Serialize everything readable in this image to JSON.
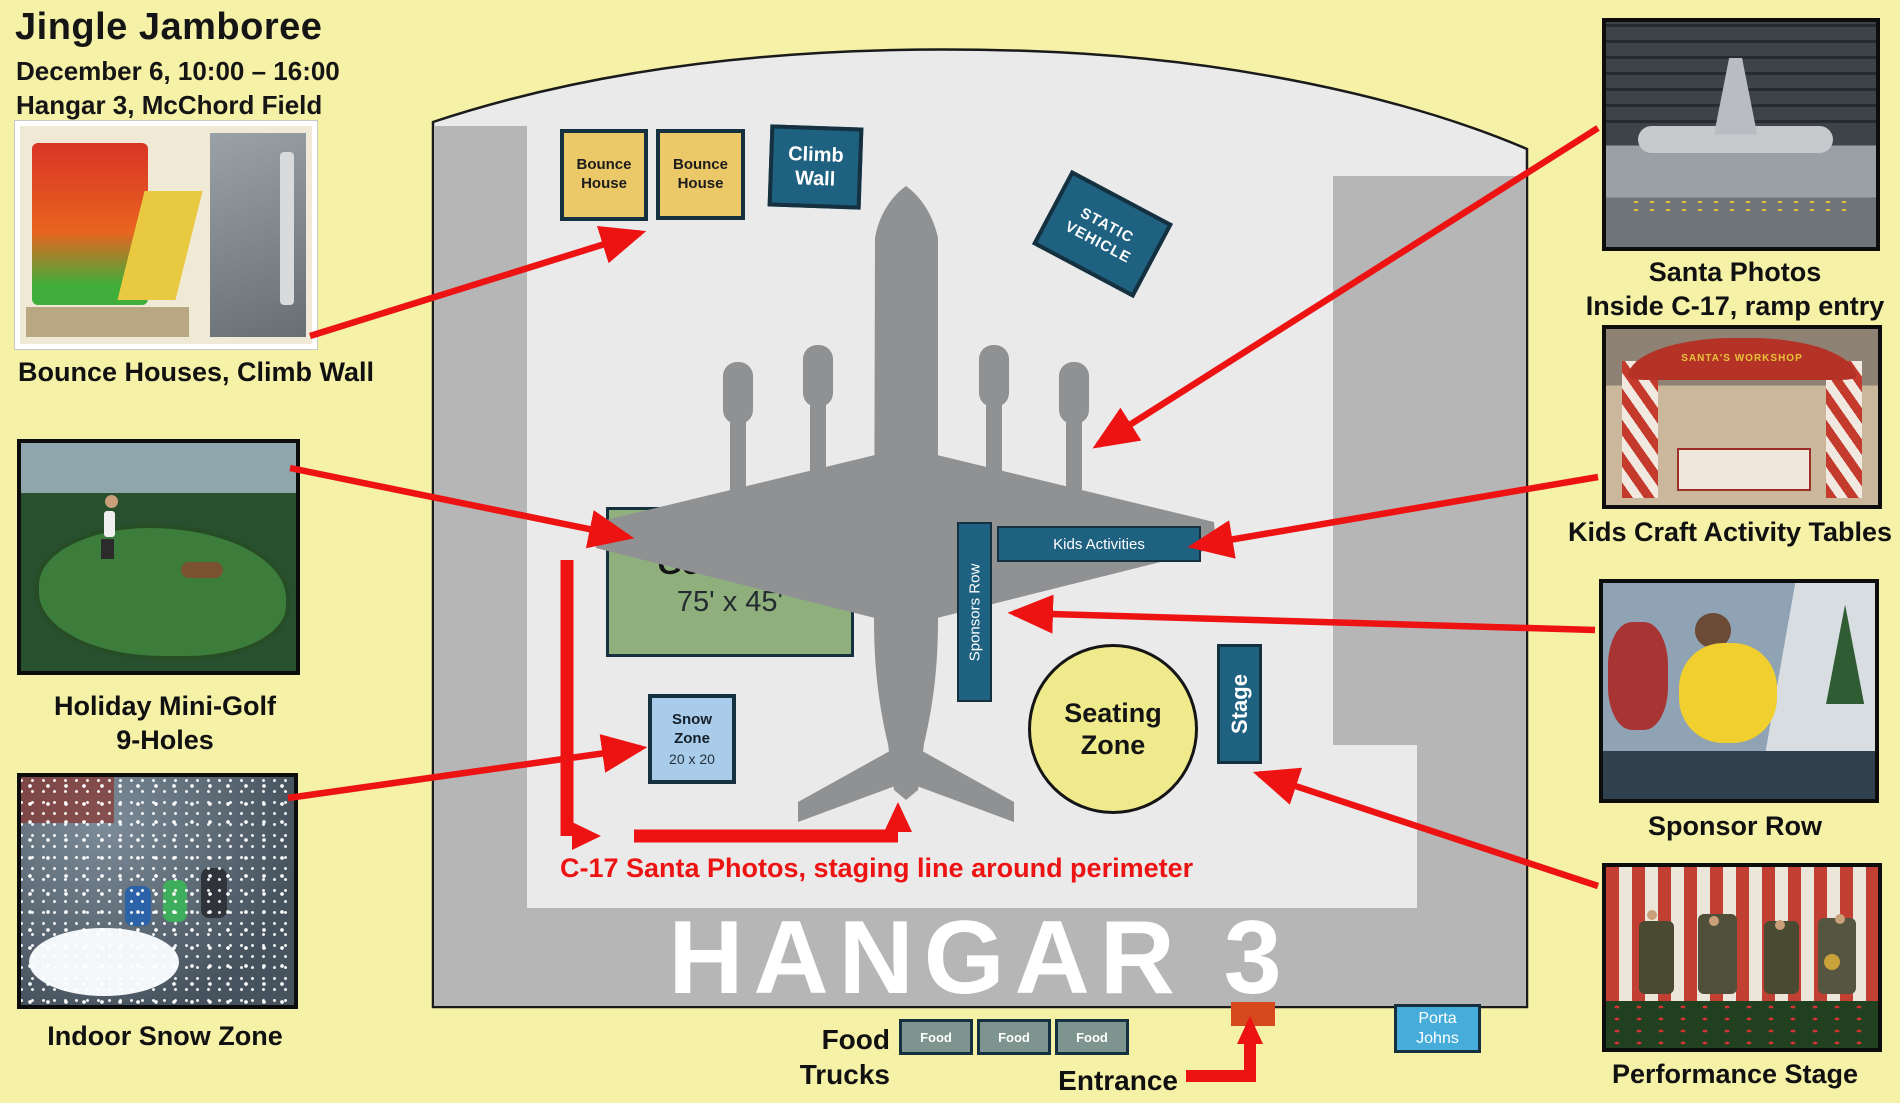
{
  "header": {
    "title": "Jingle Jamboree",
    "date": "December 6, 10:00 – 16:00",
    "venue": "Hangar 3, McChord Field"
  },
  "hangar_label": "HANGAR 3",
  "zones": {
    "bounce1": "Bounce House",
    "bounce2": "Bounce House",
    "climb_wall": "Climb Wall",
    "static_vehicle": "STATIC VEHICLE",
    "golf_title": "Golf Zone",
    "golf_dims": "75' x 45'",
    "snow_title": "Snow Zone",
    "snow_dims": "20 x 20",
    "sponsors_row": "Sponsors Row",
    "kids_activities": "Kids Activities",
    "seating": "Seating Zone",
    "stage": "Stage",
    "porta_johns": "Porta Johns",
    "food_units": [
      "Food",
      "Food",
      "Food"
    ]
  },
  "labels": {
    "food_trucks": "Food Trucks",
    "entrance": "Entrance",
    "staging_note": "C-17 Santa Photos, staging line around perimeter"
  },
  "callouts": {
    "bounce": "Bounce Houses, Climb Wall",
    "golf1": "Holiday Mini-Golf",
    "golf2": "9-Holes",
    "snow": "Indoor Snow Zone",
    "santa1": "Santa Photos",
    "santa2": "Inside C-17, ramp entry",
    "craft": "Kids Craft Activity Tables",
    "sponsor": "Sponsor Row",
    "performance": "Performance Stage"
  },
  "photo_texts": {
    "workshop_sign": "SANTA'S WORKSHOP"
  },
  "colors": {
    "background": "#F5F1A7",
    "hangar_wall": "#B6B6B6",
    "hangar_floor": "#EAEAEA",
    "aircraft_gray": "#909090",
    "zone_teal": "#1F6180",
    "zone_border_navy": "#15303F",
    "bounce_tan": "#ECC968",
    "golf_green": "#8FB07D",
    "snow_blue": "#A9CCEB",
    "seating_yellow": "#EFEB8D",
    "food_sage": "#7E948E",
    "porta_blue": "#46ADDB",
    "arrow_red": "#EE1313",
    "entrance_orange": "#D5491D"
  }
}
